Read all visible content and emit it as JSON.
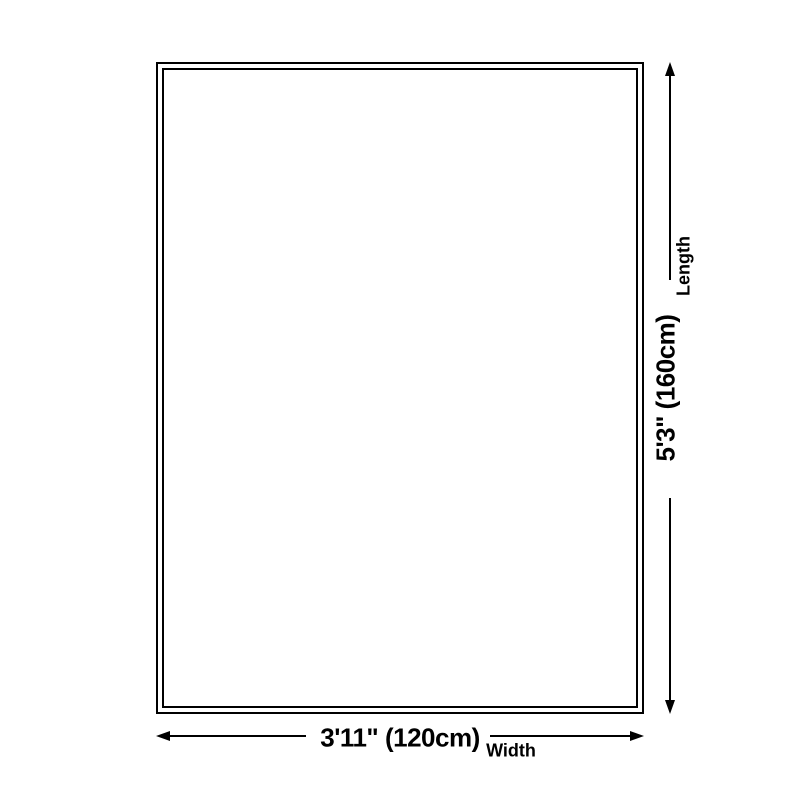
{
  "diagram": {
    "background_color": "#ffffff",
    "line_color": "#000000",
    "rug_outline": {
      "style": "double-border rectangle",
      "border_color": "#000000"
    },
    "length_dimension": {
      "value": "5'3\" (160cm)",
      "axis_label": "Length",
      "orientation": "vertical"
    },
    "width_dimension": {
      "value": "3'11\" (120cm)",
      "axis_label": "Width",
      "orientation": "horizontal"
    }
  }
}
